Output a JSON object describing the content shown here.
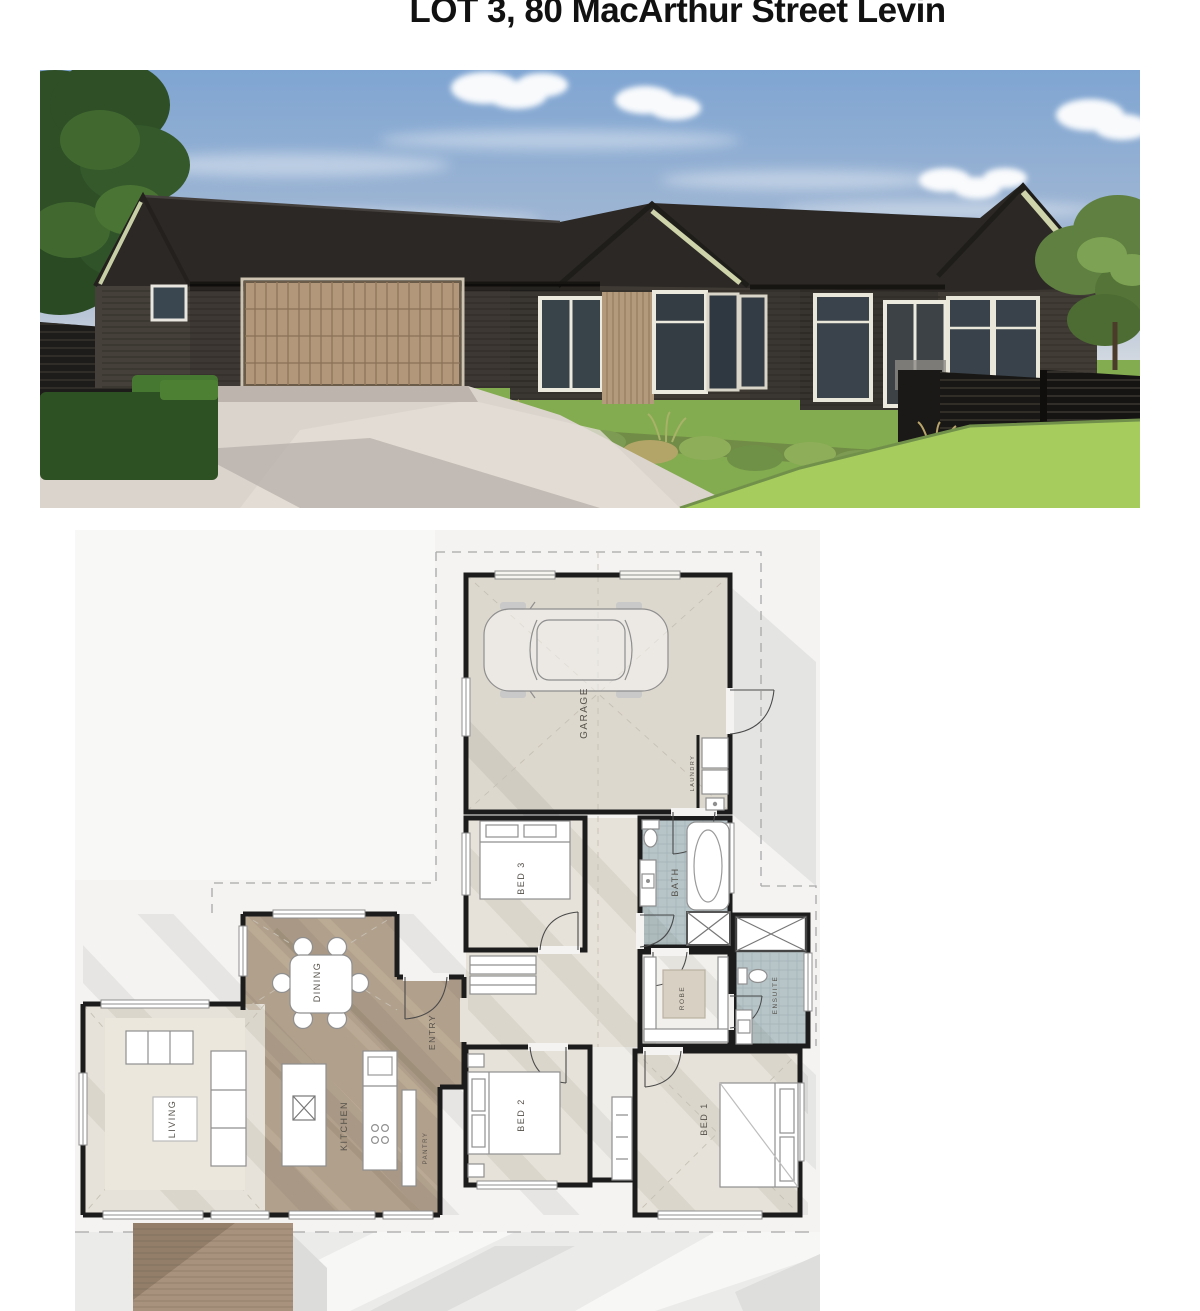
{
  "header": {
    "title": "LOT 3, 80 MacArthur Street Levin"
  },
  "photo": {
    "colors": {
      "sky": "#7fa5d2",
      "roof": "#2b2825",
      "cladding": "#3d3834",
      "timber": "#b2977a",
      "soffit": "#cfd4ab",
      "lawn": "#83ab4f",
      "lawn_bright": "#a7cc5e",
      "driveway": "#dbd4cd",
      "fence": "#181715",
      "foliage": "#2f4f27"
    }
  },
  "floor_plan": {
    "rooms": {
      "garage": {
        "label": "GARAGE"
      },
      "laundry": {
        "label": "LAUNDRY"
      },
      "bed3": {
        "label": "BED 3"
      },
      "bath": {
        "label": "BATH"
      },
      "ensuite": {
        "label": "ENSUITE"
      },
      "robe": {
        "label": "ROBE"
      },
      "bed2": {
        "label": "BED 2"
      },
      "bed1": {
        "label": "BED 1"
      },
      "entry": {
        "label": "ENTRY"
      },
      "dining": {
        "label": "DINING"
      },
      "kitchen": {
        "label": "KITCHEN"
      },
      "pantry": {
        "label": "PANTRY"
      },
      "living": {
        "label": "LIVING"
      }
    },
    "colors": {
      "wall": "#1c1c1c",
      "carpet": "#e7e2d9",
      "timber_floor": "#b1a08c",
      "tile": "#b7c5c9",
      "concrete": "#ddd8ce",
      "shadow": "#e4e4e3"
    }
  }
}
